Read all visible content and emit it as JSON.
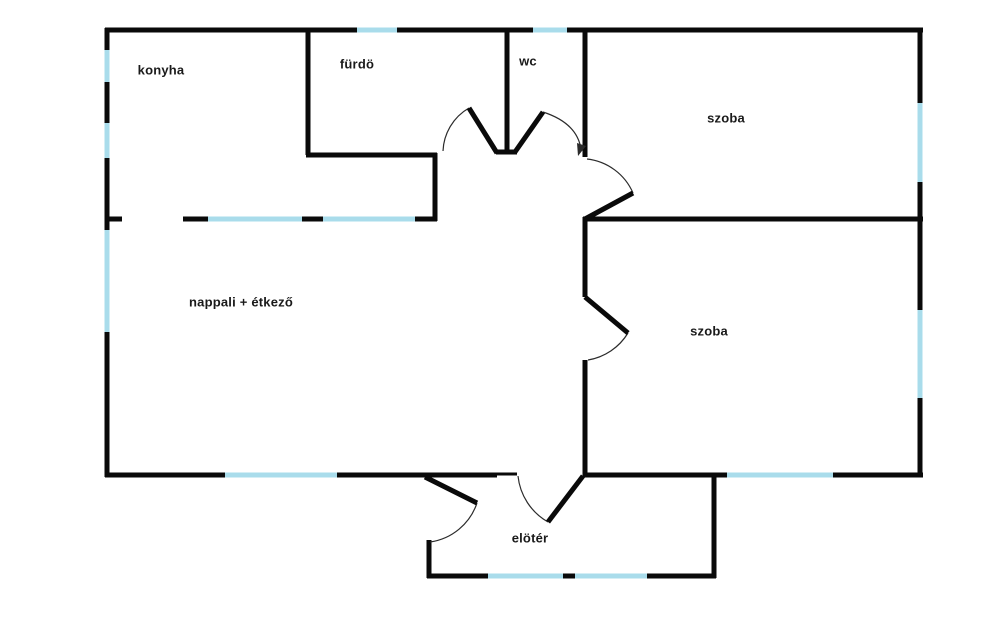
{
  "diagram": {
    "type": "floor-plan",
    "canvas": {
      "width": 1000,
      "height": 629,
      "background": "#ffffff"
    },
    "colors": {
      "wall": "#0a0a0a",
      "window": "#a9dcEB",
      "door_leaf": "#0a0a0a",
      "swing_arc": "#2b2b2b",
      "label": "#1a1a1a"
    },
    "rooms": [
      {
        "id": "konyha",
        "label": "konyha",
        "cx": 161,
        "cy": 70
      },
      {
        "id": "furdo",
        "label": "fürdö",
        "cx": 357,
        "cy": 64
      },
      {
        "id": "wc",
        "label": "wc",
        "cx": 528,
        "cy": 61
      },
      {
        "id": "szoba-top",
        "label": "szoba",
        "cx": 726,
        "cy": 118
      },
      {
        "id": "nappali",
        "label": "nappali + étkező",
        "cx": 241,
        "cy": 302
      },
      {
        "id": "szoba-bottom",
        "label": "szoba",
        "cx": 709,
        "cy": 331
      },
      {
        "id": "eloter",
        "label": "elötér",
        "cx": 530,
        "cy": 538
      }
    ],
    "walls": [
      {
        "x1": 105,
        "y1": 30,
        "x2": 357,
        "y2": 30,
        "k": "wall"
      },
      {
        "x1": 357,
        "y1": 30,
        "x2": 397,
        "y2": 30,
        "k": "window"
      },
      {
        "x1": 397,
        "y1": 30,
        "x2": 533,
        "y2": 30,
        "k": "wall"
      },
      {
        "x1": 533,
        "y1": 30,
        "x2": 567,
        "y2": 30,
        "k": "window"
      },
      {
        "x1": 567,
        "y1": 30,
        "x2": 923,
        "y2": 30,
        "k": "wall"
      },
      {
        "x1": 107,
        "y1": 28,
        "x2": 107,
        "y2": 50,
        "k": "wall"
      },
      {
        "x1": 107,
        "y1": 50,
        "x2": 107,
        "y2": 82,
        "k": "window"
      },
      {
        "x1": 107,
        "y1": 82,
        "x2": 107,
        "y2": 123,
        "k": "wall"
      },
      {
        "x1": 107,
        "y1": 123,
        "x2": 107,
        "y2": 158,
        "k": "window"
      },
      {
        "x1": 107,
        "y1": 158,
        "x2": 107,
        "y2": 230,
        "k": "wall"
      },
      {
        "x1": 107,
        "y1": 230,
        "x2": 107,
        "y2": 332,
        "k": "window"
      },
      {
        "x1": 107,
        "y1": 332,
        "x2": 107,
        "y2": 477,
        "k": "wall"
      },
      {
        "x1": 920,
        "y1": 28,
        "x2": 920,
        "y2": 103,
        "k": "wall"
      },
      {
        "x1": 920,
        "y1": 103,
        "x2": 920,
        "y2": 182,
        "k": "window"
      },
      {
        "x1": 920,
        "y1": 182,
        "x2": 920,
        "y2": 310,
        "k": "wall"
      },
      {
        "x1": 920,
        "y1": 310,
        "x2": 920,
        "y2": 398,
        "k": "window"
      },
      {
        "x1": 920,
        "y1": 398,
        "x2": 920,
        "y2": 477,
        "k": "wall"
      },
      {
        "x1": 105,
        "y1": 475,
        "x2": 225,
        "y2": 475,
        "k": "wall"
      },
      {
        "x1": 225,
        "y1": 475,
        "x2": 337,
        "y2": 475,
        "k": "window"
      },
      {
        "x1": 337,
        "y1": 475,
        "x2": 497,
        "y2": 475,
        "k": "wall"
      },
      {
        "x1": 497,
        "y1": 474,
        "x2": 517,
        "y2": 474,
        "k": "wall",
        "w": 3
      },
      {
        "x1": 583,
        "y1": 475,
        "x2": 727,
        "y2": 475,
        "k": "wall"
      },
      {
        "x1": 727,
        "y1": 475,
        "x2": 833,
        "y2": 475,
        "k": "window"
      },
      {
        "x1": 833,
        "y1": 475,
        "x2": 923,
        "y2": 475,
        "k": "wall"
      },
      {
        "x1": 308,
        "y1": 28,
        "x2": 308,
        "y2": 155,
        "k": "wall"
      },
      {
        "x1": 306,
        "y1": 155,
        "x2": 437,
        "y2": 155,
        "k": "wall"
      },
      {
        "x1": 435,
        "y1": 153,
        "x2": 435,
        "y2": 221,
        "k": "wall"
      },
      {
        "x1": 105,
        "y1": 219,
        "x2": 122,
        "y2": 219,
        "k": "wall"
      },
      {
        "x1": 183,
        "y1": 219,
        "x2": 208,
        "y2": 219,
        "k": "wall"
      },
      {
        "x1": 208,
        "y1": 219,
        "x2": 302,
        "y2": 219,
        "k": "window"
      },
      {
        "x1": 302,
        "y1": 219,
        "x2": 323,
        "y2": 219,
        "k": "wall"
      },
      {
        "x1": 323,
        "y1": 219,
        "x2": 415,
        "y2": 219,
        "k": "window"
      },
      {
        "x1": 415,
        "y1": 219,
        "x2": 437,
        "y2": 219,
        "k": "wall"
      },
      {
        "x1": 507,
        "y1": 28,
        "x2": 507,
        "y2": 152,
        "k": "wall"
      },
      {
        "x1": 496,
        "y1": 152,
        "x2": 517,
        "y2": 152,
        "k": "wall"
      },
      {
        "x1": 585,
        "y1": 28,
        "x2": 585,
        "y2": 157,
        "k": "wall"
      },
      {
        "x1": 583,
        "y1": 219,
        "x2": 923,
        "y2": 219,
        "k": "wall"
      },
      {
        "x1": 585,
        "y1": 217,
        "x2": 585,
        "y2": 297,
        "k": "wall"
      },
      {
        "x1": 585,
        "y1": 360,
        "x2": 585,
        "y2": 477,
        "k": "wall"
      },
      {
        "x1": 429,
        "y1": 540,
        "x2": 429,
        "y2": 578,
        "k": "wall"
      },
      {
        "x1": 427,
        "y1": 576,
        "x2": 488,
        "y2": 576,
        "k": "wall"
      },
      {
        "x1": 488,
        "y1": 576,
        "x2": 563,
        "y2": 576,
        "k": "window"
      },
      {
        "x1": 563,
        "y1": 576,
        "x2": 575,
        "y2": 576,
        "k": "wall"
      },
      {
        "x1": 575,
        "y1": 576,
        "x2": 647,
        "y2": 576,
        "k": "window"
      },
      {
        "x1": 647,
        "y1": 576,
        "x2": 716,
        "y2": 576,
        "k": "wall"
      },
      {
        "x1": 714,
        "y1": 473,
        "x2": 714,
        "y2": 578,
        "k": "wall"
      }
    ],
    "doors": [
      {
        "id": "furdo-door",
        "leaf": [
          497,
          153,
          469,
          108
        ],
        "arc": "M469,108 A52,52 0 0 0 443,151"
      },
      {
        "id": "wc-door",
        "leaf": [
          515,
          152,
          543,
          112
        ],
        "arc": "M543,112 Q577,123 581,149",
        "arrow": "577,143 586,146 578,156"
      },
      {
        "id": "szoba-top-door",
        "leaf": [
          585,
          219,
          633,
          193
        ],
        "arc": "M587,159 A57,57 0 0 1 633,193"
      },
      {
        "id": "szoba-bottom-door",
        "leaf": [
          585,
          297,
          628,
          333
        ],
        "arc": "M628,333 A58,58 0 0 1 588,360"
      },
      {
        "id": "front-door",
        "leaf": [
          425,
          477,
          477,
          503
        ],
        "arc": "M477,503 A58,58 0 0 1 430,542"
      },
      {
        "id": "eloter-door",
        "leaf": [
          583,
          476,
          548,
          522
        ],
        "arc": "M548,522 A60,60 0 0 1 518,476"
      }
    ]
  }
}
